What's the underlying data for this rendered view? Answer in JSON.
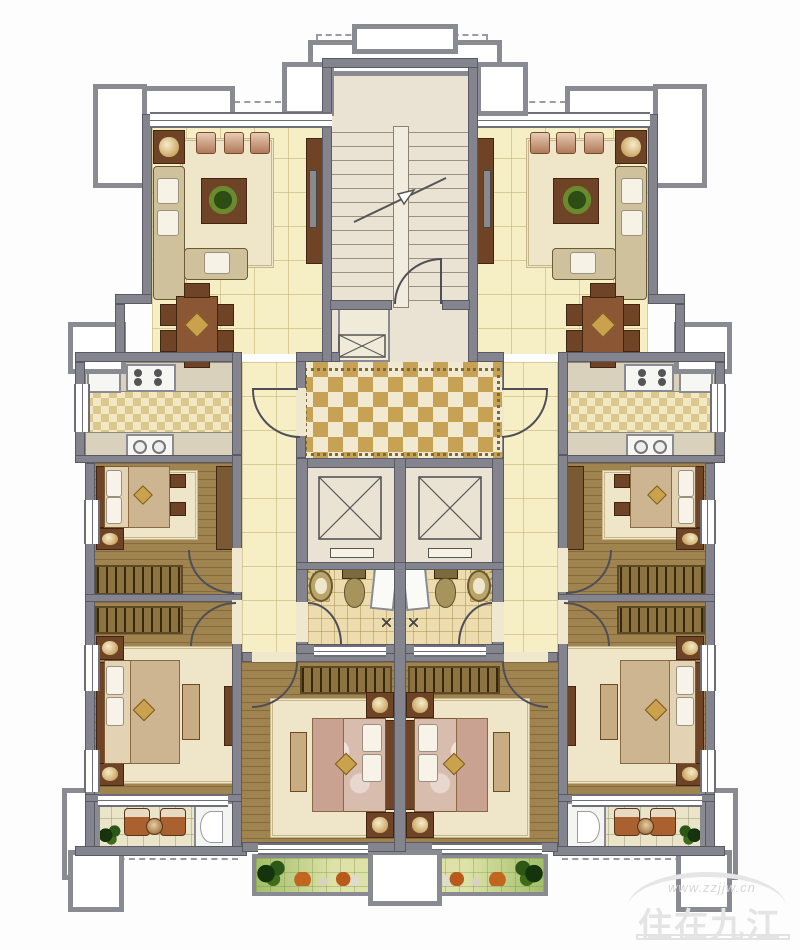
{
  "watermark": {
    "site_url": "www.zzjjw.cn",
    "logo_text": "住在九江"
  },
  "colors": {
    "wall": "#84848e",
    "floor-tile": "#f6efc6",
    "floor-wood": "#a08450",
    "floor-marble": "#eae2d2",
    "lobby-tan": "#c8a254",
    "lobby-cream": "#f1e9d0",
    "counter": "#d9d1bb"
  },
  "plan": {
    "units": 2,
    "core": [
      "stairwell",
      "entry-lobby",
      "elevator",
      "elevator"
    ],
    "unit_rooms": [
      "living-room",
      "dining-area",
      "kitchen",
      "hallway",
      "secondary-bedroom",
      "master-bedroom",
      "center-bedroom",
      "bathroom",
      "balcony",
      "flower-bed"
    ]
  }
}
